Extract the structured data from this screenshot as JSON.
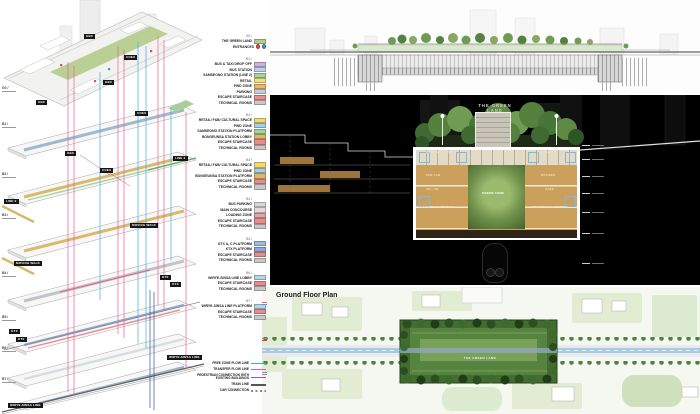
{
  "axon": {
    "levels": [
      {
        "code": "G0 /"
      },
      {
        "code": "B1 /"
      },
      {
        "code": "B2 /"
      },
      {
        "code": "B3 /"
      },
      {
        "code": "B4 /"
      },
      {
        "code": "B5 /"
      },
      {
        "code": "B6 /"
      },
      {
        "code": "B7 /"
      }
    ],
    "tags": [
      {
        "label": "GBC"
      },
      {
        "label": "COEX"
      },
      {
        "label": "GBC"
      },
      {
        "label": "GBC"
      },
      {
        "label": "COEX"
      },
      {
        "label": "GBC"
      },
      {
        "label": "COEX"
      },
      {
        "label": "LINE 2"
      },
      {
        "label": "LINE 9"
      },
      {
        "label": "MOVING WALK"
      },
      {
        "label": "MOVING WALK"
      },
      {
        "label": "KTX"
      },
      {
        "label": "GTX"
      },
      {
        "label": "GTX"
      },
      {
        "label": "KTX"
      },
      {
        "label": "WIRYE-SINSA LINE"
      },
      {
        "label": "WIRYE-SINSA LINE"
      }
    ]
  },
  "legend": {
    "groups": [
      {
        "header": "G0 /",
        "items": [
          {
            "label": "THE GREEN LAND",
            "color": "#b5cc8e"
          },
          {
            "label": "ENTRANCES",
            "color": "none"
          }
        ]
      },
      {
        "header": "B1 /",
        "items": [
          {
            "label": "BUS & TAXI DROP OFF",
            "color": "#c7b4dd"
          },
          {
            "label": "BUS STATION",
            "color": "#c5cdea"
          },
          {
            "label": "SAMSEONG STATION (LINE 2)",
            "color": "#a3d49c"
          },
          {
            "label": "RETAIL",
            "color": "#f4e077"
          },
          {
            "label": "PWD ZONE",
            "color": "#f0b468"
          },
          {
            "label": "PARKING",
            "color": "#bfcfdc"
          },
          {
            "label": "ESCAPE STAIRCASE",
            "color": "#e88c8c"
          },
          {
            "label": "TECHNICAL ROOMS",
            "color": "#c9c9c9"
          }
        ]
      },
      {
        "header": "B2 /",
        "items": [
          {
            "label": "RETAIL/ F&B/ CULTURAL SPACE",
            "color": "#f4d96e"
          },
          {
            "label": "PWD ZONE",
            "color": "#a9cfe6"
          },
          {
            "label": "SAMSEONG STATION PLATFORM",
            "color": "#a3d49c"
          },
          {
            "label": "BONGEUNSA STATION LOBBY",
            "color": "#d8b96e"
          },
          {
            "label": "ESCAPE STAIRCASE",
            "color": "#e88c8c"
          },
          {
            "label": "TECHNICAL ROOMS",
            "color": "#c9c9c9"
          }
        ]
      },
      {
        "header": "B3 /",
        "items": [
          {
            "label": "RETAIL/ F&B/ CULTURAL SPACE",
            "color": "#f4d96e"
          },
          {
            "label": "PWD ZONE",
            "color": "#a9cfe6"
          },
          {
            "label": "BONGEUNSA STATION PLATFORM",
            "color": "#d8b96e"
          },
          {
            "label": "ESCAPE STAIRCASE",
            "color": "#e88c8c"
          },
          {
            "label": "TECHNICAL ROOMS",
            "color": "#c9c9c9"
          }
        ]
      },
      {
        "header": "B4 /",
        "items": [
          {
            "label": "BUS PARKING",
            "color": "#d3d9de"
          },
          {
            "label": "MAIN CONCOURSE",
            "color": "#e6d9d9"
          },
          {
            "label": "LOADING ZONE",
            "color": "#dfa3ad"
          },
          {
            "label": "ESCAPE STAIRCASE",
            "color": "#e88c8c"
          },
          {
            "label": "TECHNICAL ROOMS",
            "color": "#c9c9c9"
          }
        ]
      },
      {
        "header": "B5 /",
        "items": [
          {
            "label": "GTX A, C PLATFORM",
            "color": "#9db9e2"
          },
          {
            "label": "KTX PLATFORM",
            "color": "#8fa6d6"
          },
          {
            "label": "ESCAPE STAIRCASE",
            "color": "#e88c8c"
          },
          {
            "label": "TECHNICAL ROOMS",
            "color": "#c9c9c9"
          }
        ]
      },
      {
        "header": "B6 /",
        "items": [
          {
            "label": "WIRYE-SINSA LINE LOBBY",
            "color": "#b3d6e8"
          },
          {
            "label": "ESCAPE STAIRCASE",
            "color": "#e88c8c"
          },
          {
            "label": "TECHNICAL ROOMS",
            "color": "#c9c9c9"
          }
        ]
      },
      {
        "header": "B7 /",
        "items": [
          {
            "label": "WIRYE-SINSA LINE PLATFORM",
            "color": "#b3d6e8"
          },
          {
            "label": "ESCAPE STAIRCASE",
            "color": "#e88c8c"
          },
          {
            "label": "TECHNICAL ROOMS",
            "color": "#c9c9c9"
          }
        ]
      }
    ],
    "entrance_markers": [
      {
        "color": "#e05050"
      },
      {
        "color": "#4a90d9"
      }
    ],
    "flow": [
      {
        "label": "FREE ZONE FLOW LINE",
        "color": "#3fa9e0"
      },
      {
        "label": "TRANSFER FLOW LINE",
        "color": "#ea5f93"
      },
      {
        "label": "PEDESTRIAN CONNECTION WITH EXISTING BUILDINGS",
        "color": "#8f5fae"
      },
      {
        "label": "TRAIN LINE",
        "color": "#555555"
      },
      {
        "label": "CAR CONNECTION",
        "color": "#888888"
      }
    ]
  },
  "night_section": {
    "title_line1": "THE GREEN",
    "title_line2": "LAND",
    "rooms": {
      "left_top": "GROUNDSCAPE",
      "right_top": "LOUNGE",
      "left_mid1": "FAB LAB",
      "left_mid2": "AR - VR",
      "right_mid1": "OFFICES",
      "right_mid2": "CAFE",
      "bottom_left": "SAMSEONG STATION",
      "bottom_right": "BONGEUNSA STATION",
      "center": "GREEN CORE"
    }
  },
  "plan": {
    "title": "Ground Floor Plan",
    "center_label": "THE GREEN LAND"
  },
  "colors": {
    "accent_pink": "#ea5f93",
    "accent_blue": "#3fa9e0"
  }
}
